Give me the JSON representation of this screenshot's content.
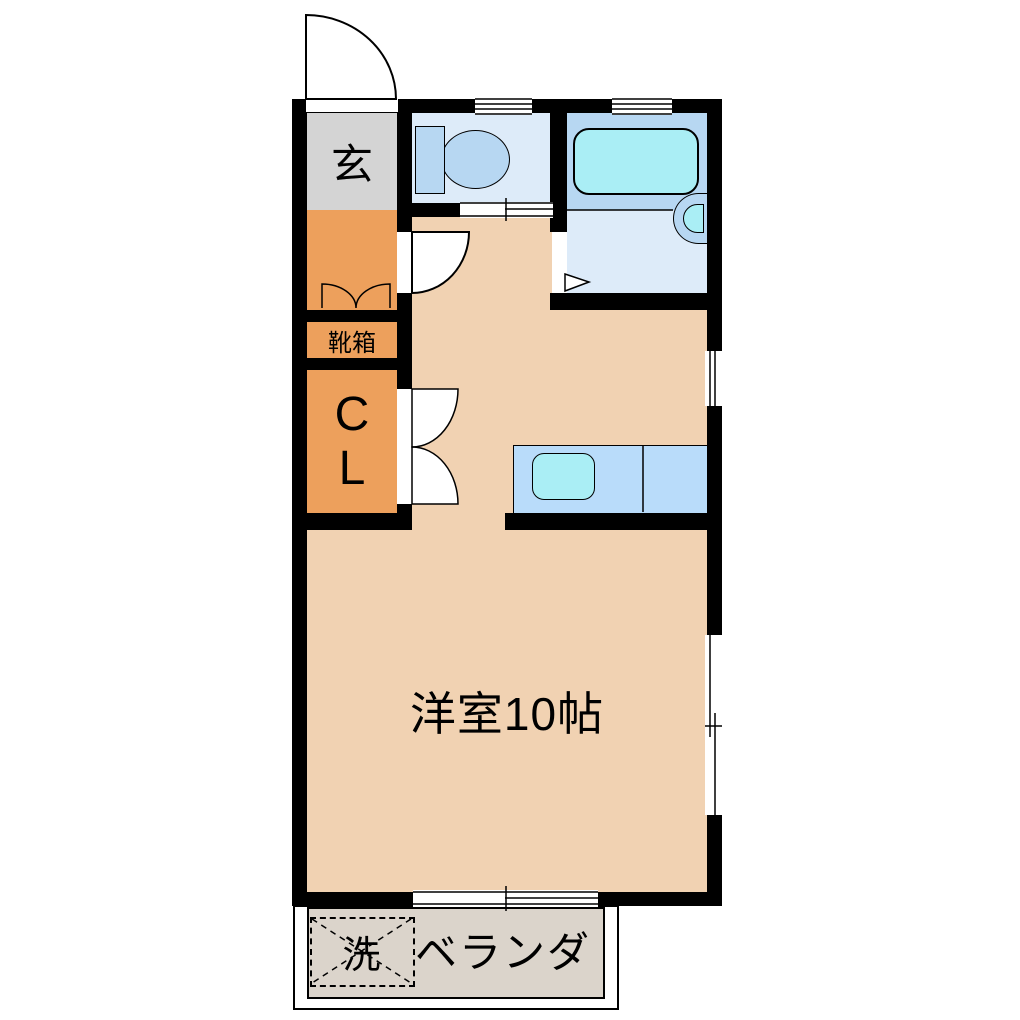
{
  "plan": {
    "labels": {
      "entrance": "玄",
      "shoe_box": "靴箱",
      "closet_line1": "C",
      "closet_line2": "L",
      "main_room": "洋室10帖",
      "veranda": "ベランダ",
      "washing_machine": "洗"
    },
    "colors": {
      "wall": "#000000",
      "floor_peach": "#F1D2B2",
      "entrance_gray": "#D4D4D4",
      "storage_orange": "#EDA05C",
      "wet_room_light_blue": "#DDEBF9",
      "fixture_blue": "#B7D7F2",
      "counter_blue": "#B9DCFA",
      "water_cyan": "#AAEEF5",
      "veranda_gray": "#DBD4CB",
      "outline": "#000000"
    }
  }
}
